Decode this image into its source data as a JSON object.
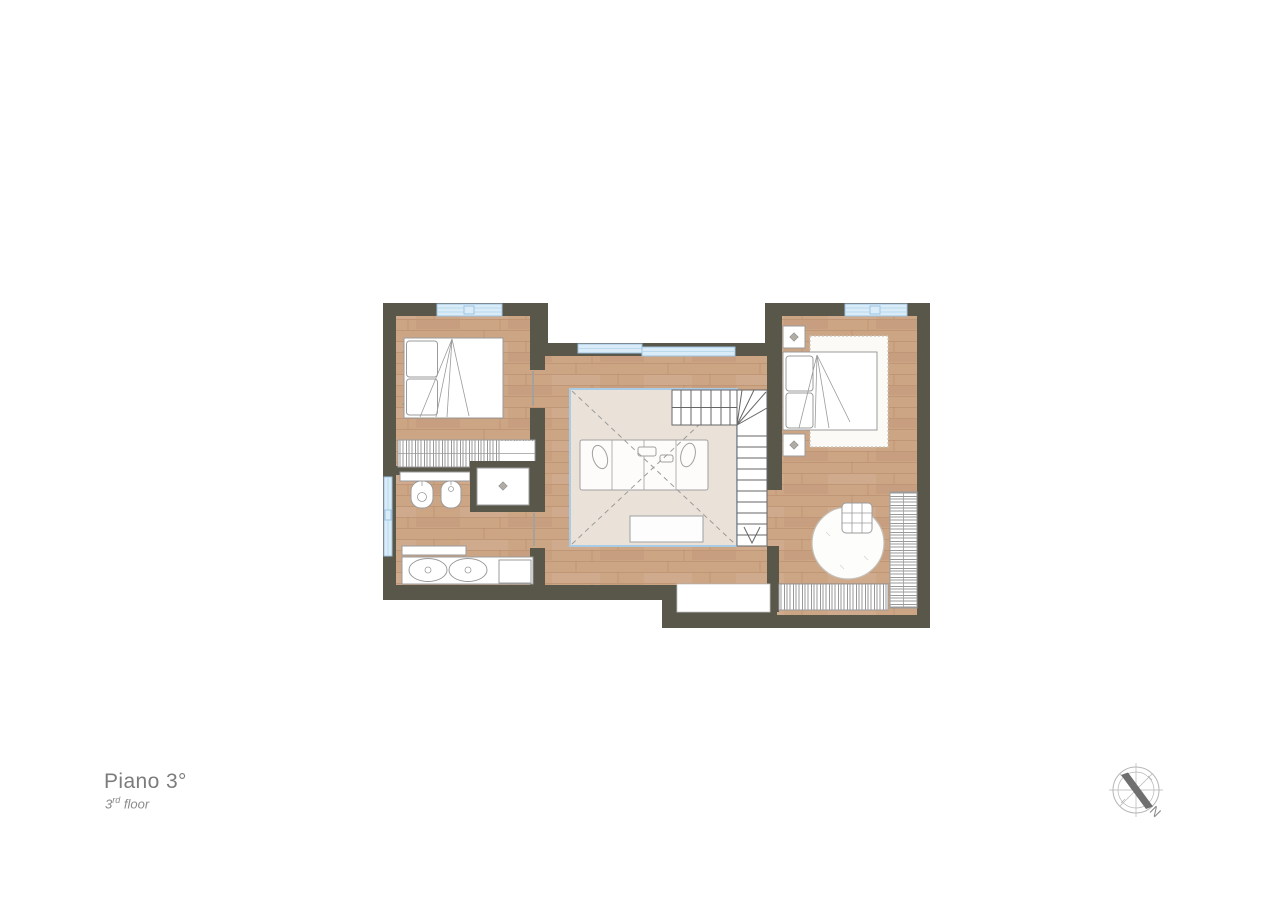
{
  "page": {
    "background": "#ffffff"
  },
  "title": {
    "label": "Piano 3°"
  },
  "subtitle": {
    "number": "3",
    "ordinal": "rd",
    "suffix": " floor"
  },
  "compass": {
    "north_label": "N"
  },
  "colors": {
    "wall": "#59564a",
    "floor_wood": "#cca585",
    "floor_seam": "#b98f6f",
    "window_fill": "#d9ecf8",
    "window_stroke": "#9fc3df",
    "window_line": "#bcdaee",
    "void_fill": "#eae2d8",
    "void_border": "#a9cbe5",
    "furniture_fill": "#ffffff",
    "furniture_stroke": "#9b9b9b",
    "hatch_line": "#8d8d8d",
    "stair_line": "#666666",
    "niche_fill": "#ffffff",
    "text_primary": "#7c7c7c",
    "text_secondary": "#8b8b8b",
    "compass_stroke": "#b5b5b5",
    "compass_needle": "#6f6f6f"
  }
}
